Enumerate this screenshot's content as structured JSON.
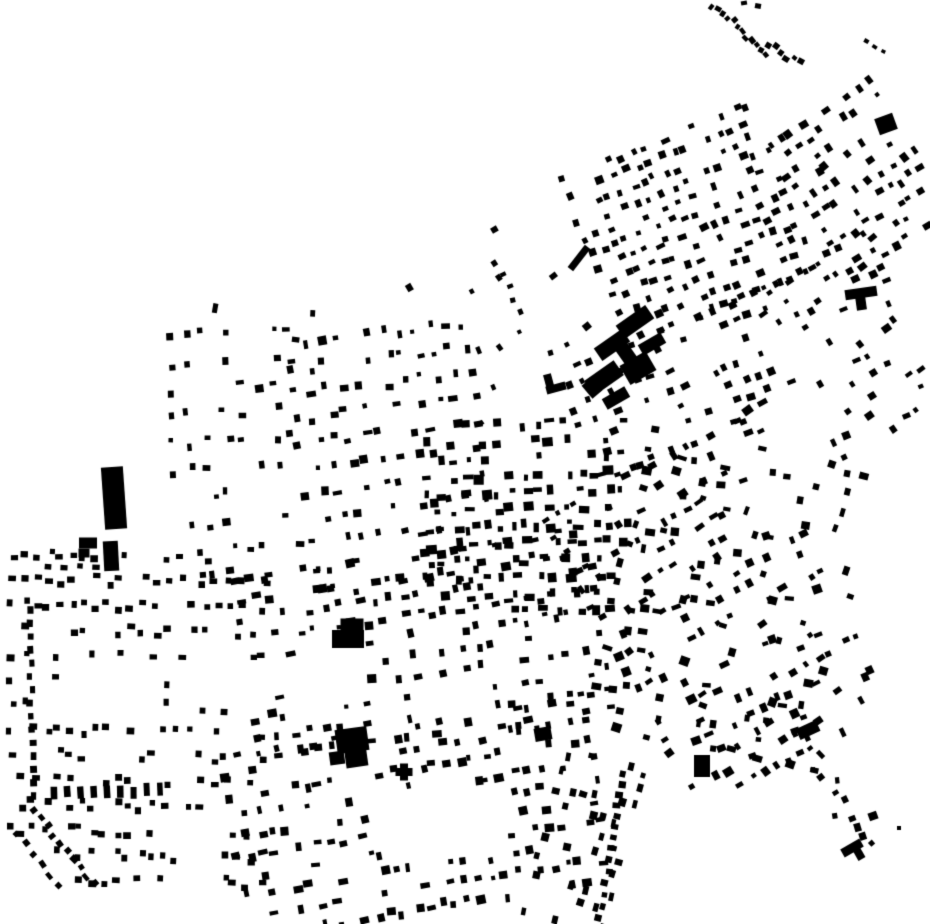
{
  "map": {
    "width": 930,
    "height": 924,
    "colors": {
      "background": "#ffffff",
      "building": "#000000"
    },
    "voids": [
      [
        58,
        656,
        88,
        58
      ],
      [
        170,
        658,
        100,
        52
      ],
      [
        293,
        650,
        68,
        50
      ],
      [
        388,
        786,
        120,
        74
      ],
      [
        430,
        678,
        64,
        42
      ]
    ],
    "grids": [
      {
        "seed": 11,
        "x": 176,
        "y": 332,
        "w": 128,
        "h": 258,
        "angle": -3,
        "row": 27,
        "col": 17,
        "skip": 0.4,
        "bw": [
          4,
          9
        ],
        "bh": [
          4,
          8
        ],
        "aj": 10
      },
      {
        "seed": 12,
        "x": 304,
        "y": 332,
        "w": 186,
        "h": 258,
        "angle": -7,
        "row": 25,
        "col": 16,
        "skip": 0.34,
        "bw": [
          4,
          10
        ],
        "bh": [
          4,
          9
        ],
        "aj": 12
      },
      {
        "seed": 13,
        "x": 196,
        "y": 288,
        "w": 130,
        "h": 50,
        "angle": 0,
        "row": 24,
        "col": 24,
        "skip": 0.72,
        "bw": [
          4,
          8
        ],
        "bh": [
          5,
          10
        ],
        "aj": 20
      },
      {
        "seed": 21,
        "x": 588,
        "y": 136,
        "w": 200,
        "h": 176,
        "angle": -22,
        "row": 16,
        "col": 12.5,
        "skip": 0.36,
        "bw": [
          4,
          9
        ],
        "bh": [
          4,
          8
        ],
        "aj": 14
      },
      {
        "seed": 22,
        "x": 572,
        "y": 308,
        "w": 218,
        "h": 142,
        "angle": -22,
        "row": 19,
        "col": 14,
        "skip": 0.52,
        "bw": [
          4,
          9
        ],
        "bh": [
          4,
          8
        ],
        "aj": 16
      },
      {
        "seed": 31,
        "x": 802,
        "y": 98,
        "w": 126,
        "h": 162,
        "angle": -33,
        "row": 17,
        "col": 13,
        "skip": 0.44,
        "bw": [
          4,
          9
        ],
        "bh": [
          4,
          9
        ],
        "aj": 15
      },
      {
        "seed": 32,
        "x": 794,
        "y": 252,
        "w": 134,
        "h": 196,
        "angle": -30,
        "row": 18,
        "col": 14,
        "skip": 0.5,
        "bw": [
          4,
          9
        ],
        "bh": [
          4,
          8
        ],
        "aj": 18
      },
      {
        "seed": 41,
        "x": 448,
        "y": 238,
        "w": 140,
        "h": 196,
        "angle": -30,
        "row": 32,
        "col": 27,
        "skip": 0.74,
        "bw": [
          4,
          8
        ],
        "bh": [
          4,
          8
        ],
        "aj": 25
      },
      {
        "seed": 51,
        "x": 428,
        "y": 424,
        "w": 204,
        "h": 198,
        "angle": -2,
        "row": 17,
        "col": 14,
        "skip": 0.38,
        "bw": [
          4,
          11
        ],
        "bh": [
          4,
          10
        ],
        "aj": 8
      },
      {
        "seed": 61,
        "x": 10,
        "y": 556,
        "w": 252,
        "h": 344,
        "angle": 1,
        "row": 25,
        "col": 12,
        "skip": 0.42,
        "bw": [
          5,
          8
        ],
        "bh": [
          5,
          7
        ],
        "aj": 4,
        "clip": [
          [
            -0.7,
            1,
            826
          ]
        ]
      },
      {
        "seed": 71,
        "x": 248,
        "y": 554,
        "w": 362,
        "h": 182,
        "angle": -8,
        "row": 20,
        "col": 13.5,
        "skip": 0.42,
        "bw": [
          4,
          10
        ],
        "bh": [
          4,
          9
        ],
        "aj": 10
      },
      {
        "seed": 72,
        "x": 235,
        "y": 728,
        "w": 372,
        "h": 196,
        "angle": -9,
        "row": 20,
        "col": 13,
        "skip": 0.42,
        "bw": [
          4,
          10
        ],
        "bh": [
          4,
          9
        ],
        "aj": 10
      },
      {
        "seed": 73,
        "x": 545,
        "y": 760,
        "w": 80,
        "h": 164,
        "angle": 14,
        "row": 18,
        "col": 13,
        "skip": 0.55,
        "bw": [
          4,
          8
        ],
        "bh": [
          5,
          9
        ],
        "aj": 8
      },
      {
        "seed": 81,
        "x": 608,
        "y": 438,
        "w": 270,
        "h": 324,
        "angle": -28,
        "row": 19,
        "col": 14.5,
        "skip": 0.56,
        "bw": [
          4,
          10
        ],
        "bh": [
          4,
          9
        ],
        "aj": 18,
        "fade": 0.66
      },
      {
        "seed": 82,
        "x": 618,
        "y": 452,
        "w": 258,
        "h": 302,
        "angle": 12,
        "row": 20,
        "col": 15.5,
        "skip": 0.6,
        "bw": [
          4,
          10
        ],
        "bh": [
          4,
          9
        ],
        "aj": 18,
        "fade": 0.66
      }
    ],
    "strings": [
      {
        "seed": 91,
        "p": [
          712,
          6,
          768,
          52
        ],
        "n": 12,
        "bw": [
          4,
          7
        ],
        "bh": [
          4,
          6
        ],
        "jit": 4,
        "aj": 30
      },
      {
        "seed": 92,
        "p": [
          768,
          46,
          800,
          63
        ],
        "n": 6,
        "bw": [
          4,
          7
        ],
        "bh": [
          4,
          6
        ],
        "jit": 4,
        "aj": 30
      },
      {
        "seed": 93,
        "p": [
          866,
          42,
          884,
          50
        ],
        "n": 3,
        "bw": [
          4,
          6
        ],
        "bh": [
          3,
          5
        ],
        "jit": 2,
        "aj": 20
      },
      {
        "seed": 94,
        "p": [
          798,
          720,
          862,
          848
        ],
        "n": 15,
        "bw": [
          4,
          9
        ],
        "bh": [
          4,
          7
        ],
        "jit": 11,
        "aj": 45
      },
      {
        "seed": 95,
        "p": [
          623,
          774,
          612,
          848
        ],
        "n": 8,
        "bw": [
          5,
          7
        ],
        "bh": [
          5,
          8
        ],
        "jit": 2,
        "aj": 10
      },
      {
        "seed": 96,
        "p": [
          612,
          848,
          599,
          918
        ],
        "n": 7,
        "bw": [
          5,
          7
        ],
        "bh": [
          5,
          8
        ],
        "jit": 2,
        "aj": 10
      },
      {
        "seed": 97,
        "p": [
          34,
          810,
          94,
          884
        ],
        "n": 10,
        "bw": [
          5,
          8
        ],
        "bh": [
          4,
          7
        ],
        "jit": 3,
        "aj": 12
      },
      {
        "seed": 98,
        "p": [
          16,
          834,
          58,
          886
        ],
        "n": 6,
        "bw": [
          5,
          8
        ],
        "bh": [
          4,
          7
        ],
        "jit": 3,
        "aj": 12
      },
      {
        "seed": 99,
        "p": [
          54,
          794,
          160,
          790
        ],
        "n": 9,
        "bw": [
          5,
          7
        ],
        "bh": [
          11,
          14
        ],
        "jit": 2,
        "aj": 4
      },
      {
        "seed": 101,
        "p": [
          29,
          610,
          33,
          796
        ],
        "n": 15,
        "bw": [
          6,
          8
        ],
        "bh": [
          5,
          7
        ],
        "jit": 2,
        "aj": 5
      },
      {
        "seed": 102,
        "p": [
          48,
          566,
          112,
          566
        ],
        "n": 5,
        "bw": [
          5,
          8
        ],
        "bh": [
          4,
          6
        ],
        "jit": 2,
        "aj": 8
      },
      {
        "seed": 104,
        "p": [
          497,
          262,
          520,
          312
        ],
        "n": 5,
        "bw": [
          4,
          6
        ],
        "bh": [
          4,
          6
        ],
        "jit": 3,
        "aj": 30
      }
    ],
    "landmarks": [
      [
        114,
        498,
        22,
        62,
        -4
      ],
      [
        111,
        556,
        15,
        30,
        -3
      ],
      [
        88,
        543,
        18,
        11,
        0
      ],
      [
        84,
        553,
        11,
        9,
        0
      ],
      [
        635,
        322,
        36,
        16,
        -35
      ],
      [
        612,
        345,
        34,
        15,
        -35
      ],
      [
        625,
        352,
        14,
        40,
        -35
      ],
      [
        604,
        378,
        36,
        18,
        -35
      ],
      [
        638,
        368,
        30,
        22,
        -30
      ],
      [
        652,
        344,
        26,
        12,
        -30
      ],
      [
        616,
        398,
        26,
        12,
        -30
      ],
      [
        592,
        388,
        13,
        17,
        -40
      ],
      [
        886,
        124,
        19,
        17,
        -20
      ],
      [
        861,
        293,
        32,
        10,
        -8
      ],
      [
        861,
        303,
        10,
        14,
        -8
      ],
      [
        352,
        625,
        23,
        13,
        0
      ],
      [
        348,
        639,
        32,
        18,
        0
      ],
      [
        352,
        740,
        32,
        24,
        -8
      ],
      [
        356,
        756,
        22,
        22,
        -8
      ],
      [
        337,
        758,
        15,
        13,
        -8
      ],
      [
        404,
        772,
        8,
        17,
        0
      ],
      [
        404,
        772,
        17,
        8,
        0
      ],
      [
        702,
        766,
        16,
        22,
        0
      ],
      [
        543,
        734,
        17,
        13,
        -10
      ],
      [
        852,
        848,
        22,
        9,
        -30
      ],
      [
        858,
        852,
        8,
        16,
        -30
      ],
      [
        579,
        258,
        7,
        28,
        38
      ],
      [
        808,
        730,
        22,
        12,
        -25
      ],
      [
        556,
        388,
        20,
        8,
        -15
      ],
      [
        549,
        382,
        8,
        16,
        -15
      ],
      [
        873,
        816,
        9,
        8,
        -20
      ],
      [
        899,
        828,
        4,
        4,
        0
      ],
      [
        758,
        6,
        6,
        5,
        10
      ],
      [
        744,
        3,
        6,
        4,
        -10
      ]
    ]
  }
}
